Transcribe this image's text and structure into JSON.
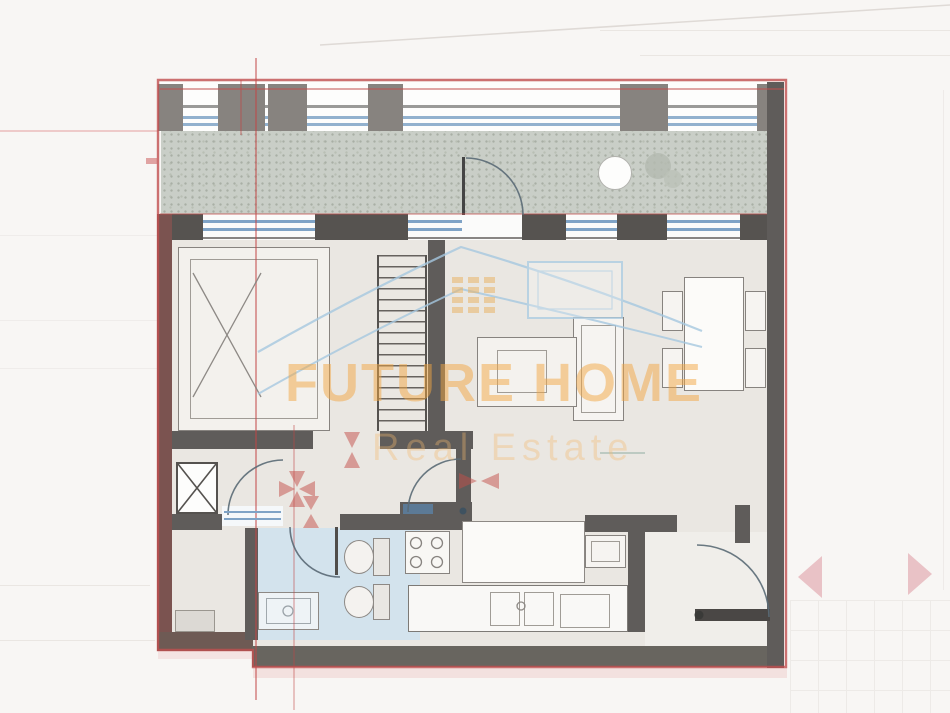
{
  "watermark": {
    "brand": "FUTURE HOME",
    "subtitle": "Real Estate"
  },
  "colors": {
    "boundary_red": "#c14f4f",
    "wall_gray": "#5f5c5a",
    "wall_brown": "#7b5350",
    "window_blue": "#7fa3c6",
    "bathroom_floor_blue": "#d3e3ed",
    "balcony_floor_gray": "#c9cec7",
    "interior_floor": "#eae7e2",
    "watermark_orange": "#f2a642",
    "logo_blue": "#a6c8e0",
    "marker_red": "#c4504a",
    "side_arrow_pink": "#d68290"
  }
}
